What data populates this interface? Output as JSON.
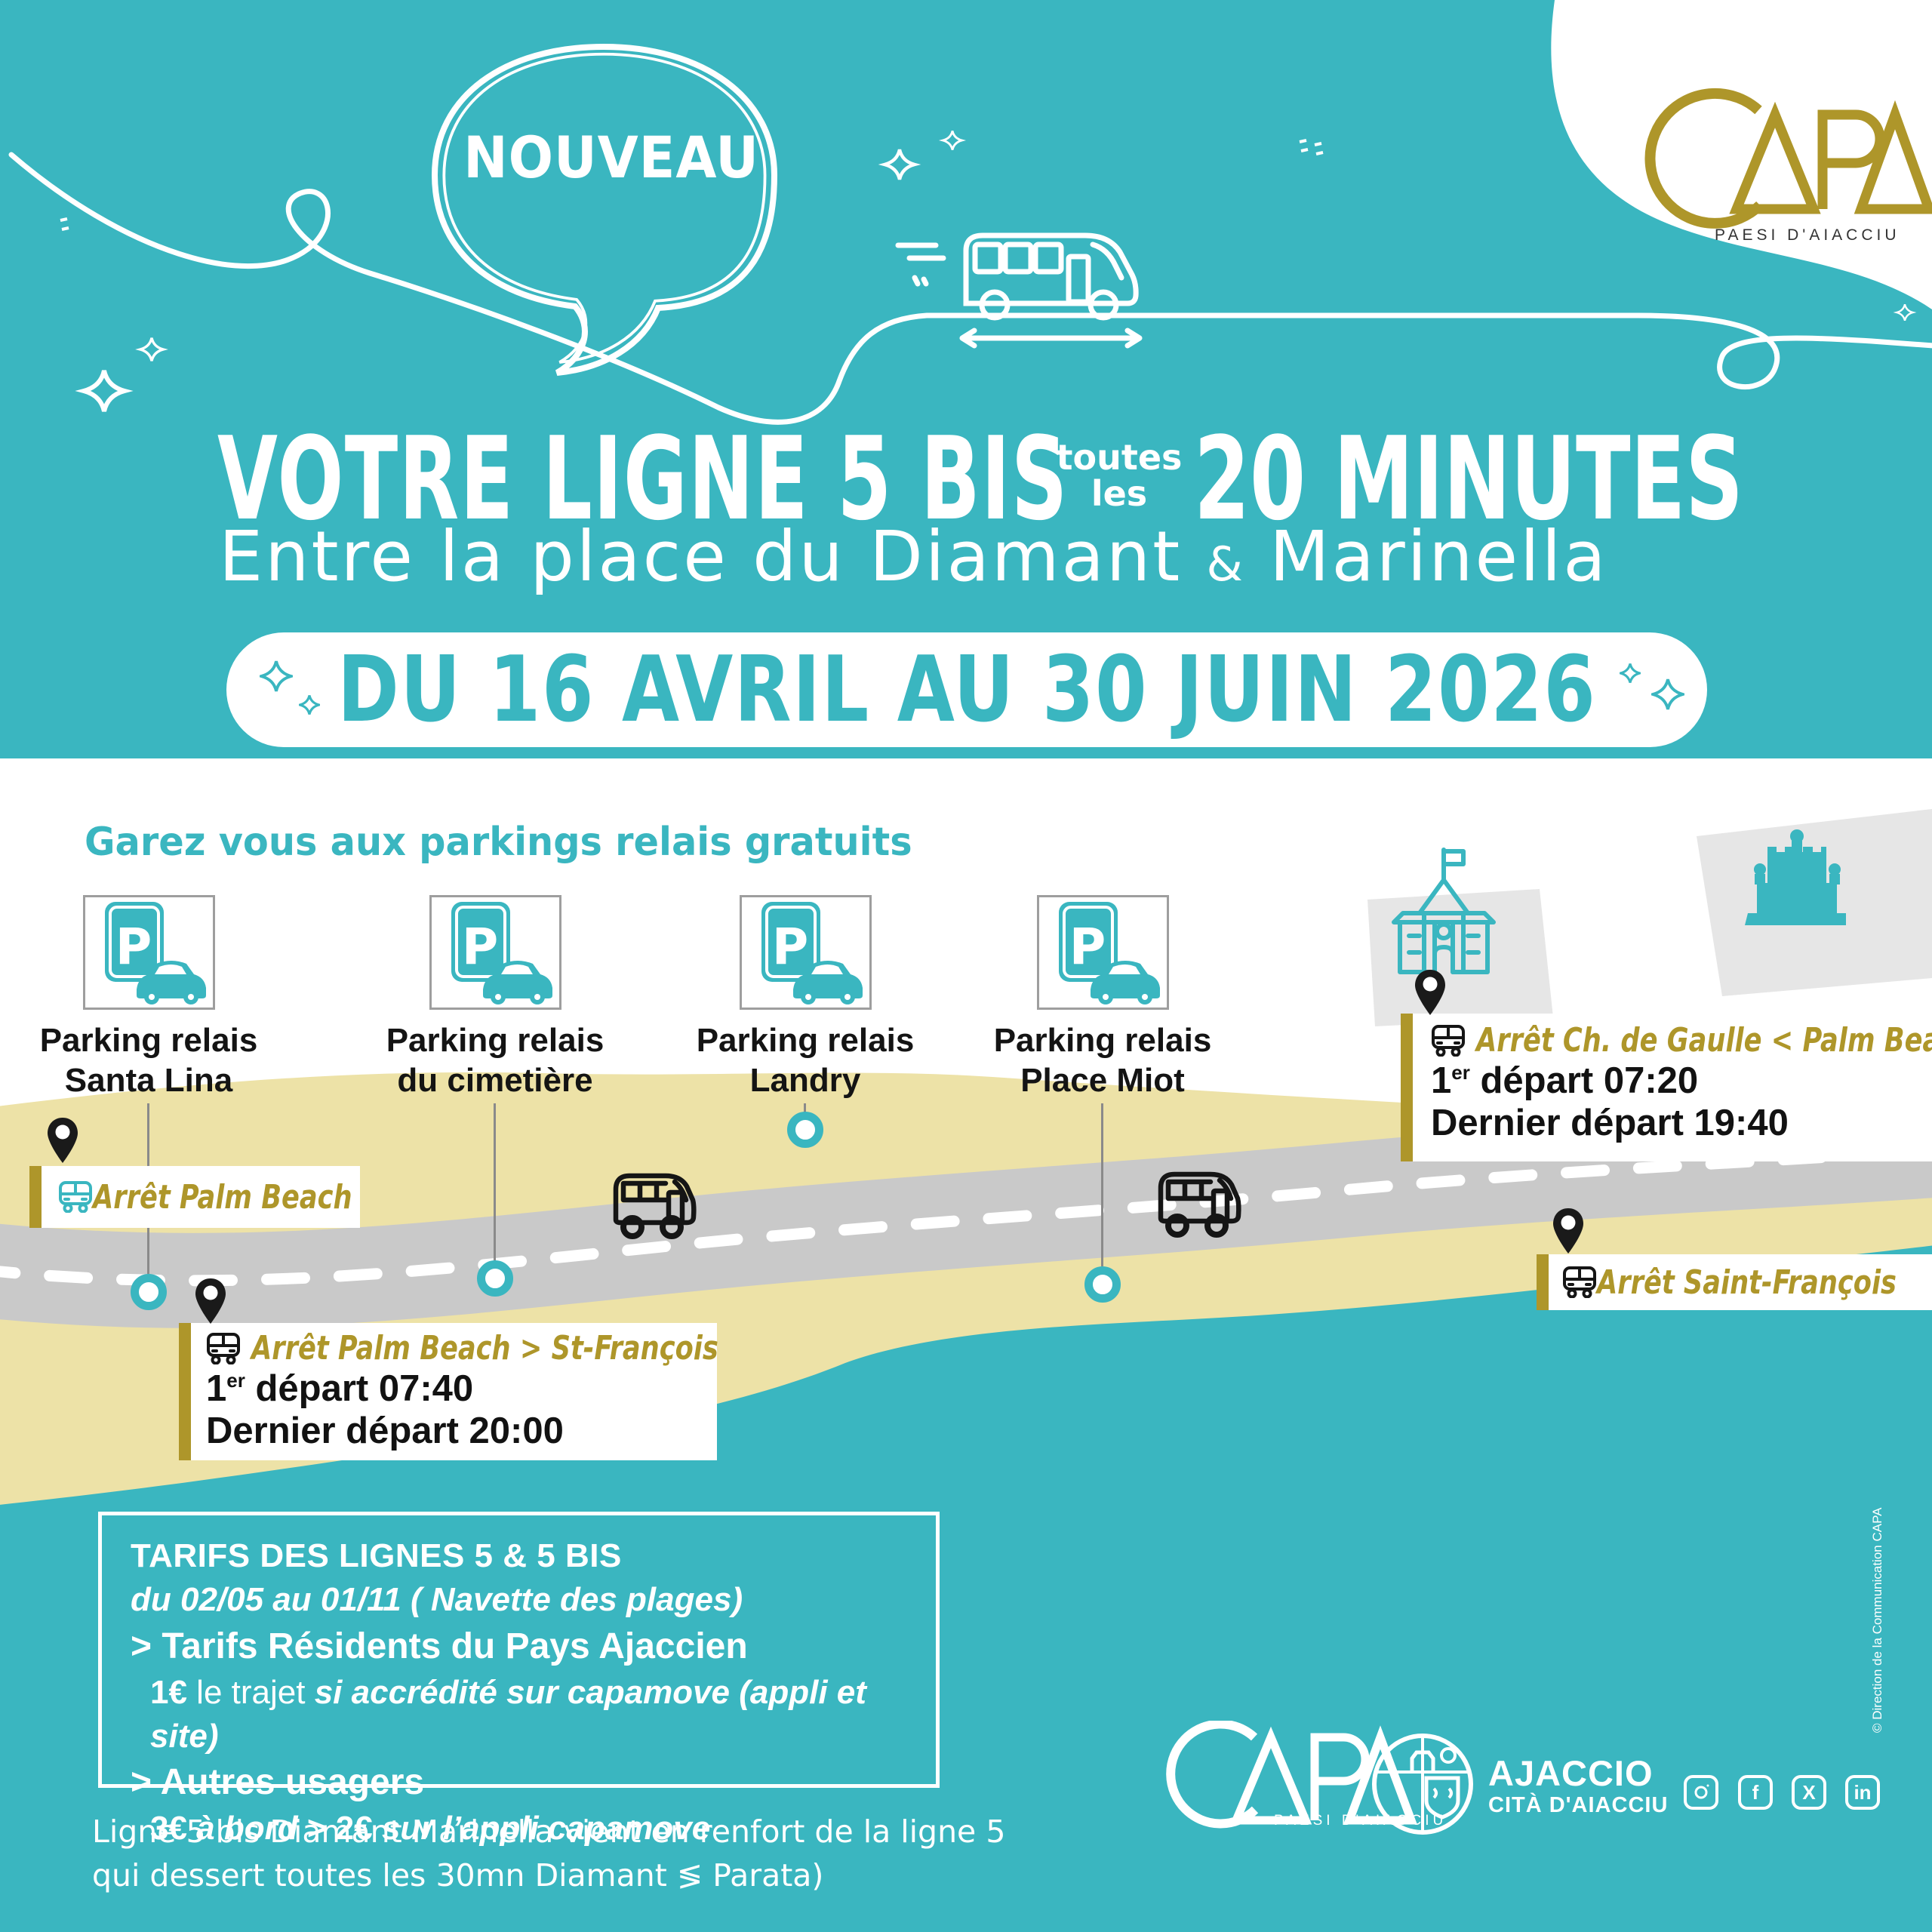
{
  "colors": {
    "teal": "#3AB6C0",
    "gold": "#AE962A",
    "sand": "#EDE2A7",
    "road_gray": "#C9C9C9",
    "blob_gray": "#E6E6E6",
    "ink": "#1A1A1A"
  },
  "header": {
    "nouveau_label": "NOUVEAU",
    "title_line1_main": "VOTRE LIGNE 5 BIS",
    "title_line1_small_top": "toutes",
    "title_line1_small_bottom": "les",
    "title_line1_end": "20 MINUTES",
    "subtitle_pre": "Entre la place du Diamant",
    "subtitle_amp": "&",
    "subtitle_post": "Marinella",
    "date_banner": "DU 16 AVRIL AU 30 JUIN 2026",
    "logo_name": "CAPA",
    "logo_tagline": "PAESI D'AIACCIU"
  },
  "map": {
    "heading": "Garez vous aux parkings relais gratuits",
    "parkings": [
      {
        "line1": "Parking relais",
        "line2": "Santa Lina"
      },
      {
        "line1": "Parking relais",
        "line2": "du cimetière"
      },
      {
        "line1": "Parking relais",
        "line2": "Landry"
      },
      {
        "line1": "Parking relais",
        "line2": "Place Miot"
      }
    ],
    "stops": {
      "palm_beach": {
        "label": "Arrêt Palm Beach"
      },
      "ch_de_gaulle": {
        "label": "Arrêt Ch. de Gaulle < Palm Beach",
        "first_num": "1",
        "first_sup": "er",
        "first_rest": " départ 07:20",
        "last": "Dernier départ 19:40"
      },
      "palm_beach_st_francois": {
        "label": "Arrêt Palm Beach > St-François",
        "first_num": "1",
        "first_sup": "er",
        "first_rest": " départ 07:40",
        "last": "Dernier départ 20:00"
      },
      "saint_francois": {
        "label": "Arrêt Saint-François"
      }
    }
  },
  "tarifs": {
    "title": "TARIFS DES LIGNES 5 & 5 BIS",
    "subtitle": "du 02/05 au 01/11 ( Navette des plages)",
    "resident_header": "> Tarifs Résidents du Pays Ajaccien",
    "resident_price": "1€",
    "resident_mid": " le trajet ",
    "resident_detail": "si accrédité sur capamove (appli et site)",
    "others_header": "> Autres usagers",
    "others_p1": "3€",
    "others_p2": " à bord ",
    "others_p3": "> ",
    "others_p4": "2€",
    "others_p5": " sur l’appli capamove"
  },
  "note": {
    "line1": "Ligne 5 bis Diamant Marinella vient en renfort de la ligne 5",
    "line2": "qui dessert toutes les 30mn Diamant ≶ Parata)"
  },
  "footer": {
    "capa_logo_name": "CAPA",
    "capa_tagline": "PAESI D'AIACCIU",
    "city_name": "AJACCIO",
    "city_subtitle": "CITÀ D'AIACCIU",
    "social_glyphs": {
      "facebook": "f",
      "x": "X",
      "linkedin": "in"
    }
  },
  "copyright": "© Direction de la Communication CAPA"
}
